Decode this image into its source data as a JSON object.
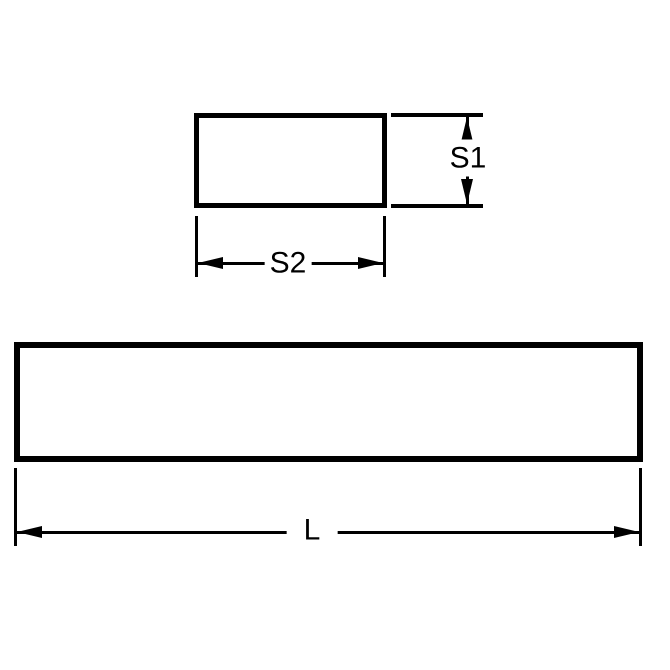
{
  "diagram": {
    "type": "technical-drawing",
    "background_color": "#ffffff",
    "line_color": "#000000",
    "views": {
      "cross_section": "end view rectangle with height and width dimensions",
      "side": "long side view rectangle with length dimension"
    },
    "labels": {
      "s1": "S1",
      "s2": "S2",
      "l": "L"
    }
  }
}
